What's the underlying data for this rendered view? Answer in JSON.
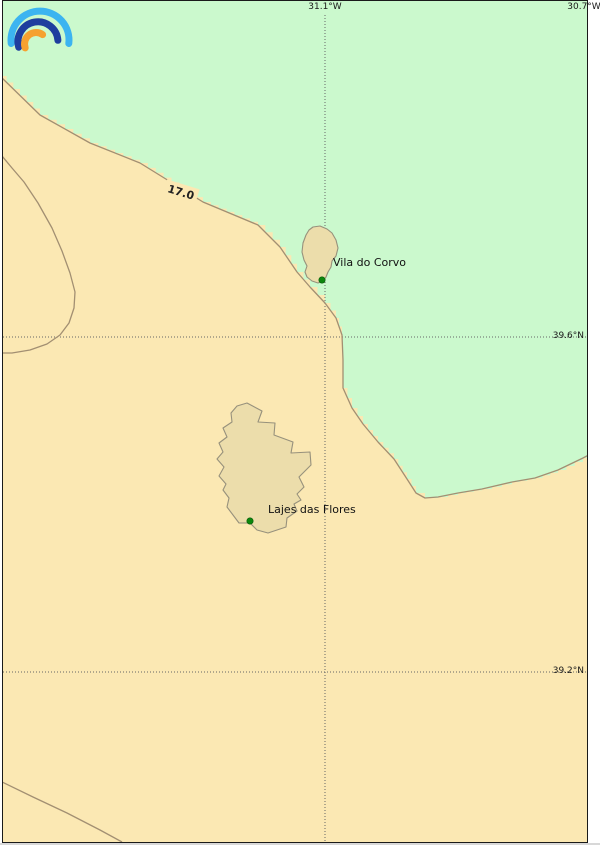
{
  "map": {
    "colors": {
      "sea_cool": "#cbf9cd",
      "sea_warm": "#fbe8b3",
      "island_fill": "#ecddab",
      "island_stroke": "#97917c",
      "contour": "#a28f72",
      "grid": "#666666",
      "border": "#1a1a1a",
      "marker": "#0c870c",
      "outside": "#ffffff",
      "bottom_strip": "#d8d8d8"
    },
    "logo_colors": {
      "outer": "#3cb4f0",
      "middle": "#1e3e9e",
      "inner": "#f6a12f"
    },
    "gridlines": {
      "meridians": [
        {
          "label": "31.1°W",
          "x": 325
        },
        {
          "label": "30.7°W",
          "x": 591
        }
      ],
      "parallels": [
        {
          "label": "39.6°N",
          "y": 337
        },
        {
          "label": "39.2°N",
          "y": 672
        }
      ]
    },
    "contour_label": {
      "text": "17.0"
    },
    "places": [
      {
        "name": "Vila do Corvo",
        "x": 322,
        "y": 280
      },
      {
        "name": "Lajes das Flores",
        "x": 250,
        "y": 521
      }
    ],
    "geometry": {
      "step_px": 9,
      "main_isoline": [
        [
          0,
          76
        ],
        [
          40,
          115
        ],
        [
          90,
          143
        ],
        [
          140,
          163
        ],
        [
          203,
          202
        ],
        [
          258,
          225
        ],
        [
          280,
          247
        ],
        [
          297,
          272
        ],
        [
          310,
          287
        ],
        [
          325,
          303
        ],
        [
          336,
          318
        ],
        [
          342,
          335
        ],
        [
          343,
          360
        ],
        [
          343,
          388
        ],
        [
          352,
          408
        ],
        [
          363,
          424
        ],
        [
          378,
          442
        ],
        [
          394,
          459
        ],
        [
          407,
          479
        ],
        [
          416,
          493
        ],
        [
          425,
          498
        ],
        [
          438,
          497
        ],
        [
          458,
          493
        ],
        [
          482,
          489
        ],
        [
          512,
          482
        ],
        [
          535,
          478
        ],
        [
          558,
          470
        ],
        [
          583,
          458
        ],
        [
          596,
          451
        ]
      ],
      "west_loop": [
        [
          2,
          156
        ],
        [
          12,
          168
        ],
        [
          24,
          182
        ],
        [
          38,
          203
        ],
        [
          52,
          228
        ],
        [
          62,
          251
        ],
        [
          70,
          273
        ],
        [
          75,
          292
        ],
        [
          74,
          308
        ],
        [
          69,
          323
        ],
        [
          60,
          335
        ],
        [
          47,
          344
        ],
        [
          30,
          350
        ],
        [
          12,
          353
        ],
        [
          0,
          353
        ]
      ],
      "southwest_line": [
        [
          0,
          781
        ],
        [
          33,
          797
        ],
        [
          67,
          813
        ],
        [
          100,
          830
        ],
        [
          122,
          842
        ]
      ],
      "corvo_island": [
        [
          313,
          227
        ],
        [
          320,
          226
        ],
        [
          327,
          229
        ],
        [
          332,
          233
        ],
        [
          336,
          240
        ],
        [
          338,
          248
        ],
        [
          336,
          256
        ],
        [
          332,
          261
        ],
        [
          331,
          267
        ],
        [
          328,
          272
        ],
        [
          326,
          277
        ],
        [
          323,
          281
        ],
        [
          318,
          283
        ],
        [
          312,
          281
        ],
        [
          307,
          277
        ],
        [
          305,
          272
        ],
        [
          307,
          266
        ],
        [
          304,
          260
        ],
        [
          302,
          252
        ],
        [
          303,
          243
        ],
        [
          306,
          235
        ],
        [
          309,
          230
        ]
      ],
      "flores_island": [
        [
          247,
          403
        ],
        [
          262,
          411
        ],
        [
          258,
          422
        ],
        [
          275,
          423
        ],
        [
          274,
          435
        ],
        [
          293,
          442
        ],
        [
          291,
          453
        ],
        [
          310,
          452
        ],
        [
          311,
          465
        ],
        [
          299,
          477
        ],
        [
          304,
          487
        ],
        [
          297,
          494
        ],
        [
          301,
          500
        ],
        [
          294,
          504
        ],
        [
          297,
          511
        ],
        [
          287,
          518
        ],
        [
          286,
          527
        ],
        [
          277,
          530
        ],
        [
          268,
          533
        ],
        [
          257,
          530
        ],
        [
          250,
          523
        ],
        [
          239,
          523
        ],
        [
          233,
          515
        ],
        [
          227,
          507
        ],
        [
          229,
          498
        ],
        [
          223,
          490
        ],
        [
          226,
          484
        ],
        [
          219,
          476
        ],
        [
          224,
          467
        ],
        [
          217,
          459
        ],
        [
          223,
          452
        ],
        [
          219,
          443
        ],
        [
          227,
          437
        ],
        [
          223,
          428
        ],
        [
          232,
          422
        ],
        [
          231,
          413
        ],
        [
          237,
          406
        ]
      ]
    }
  }
}
